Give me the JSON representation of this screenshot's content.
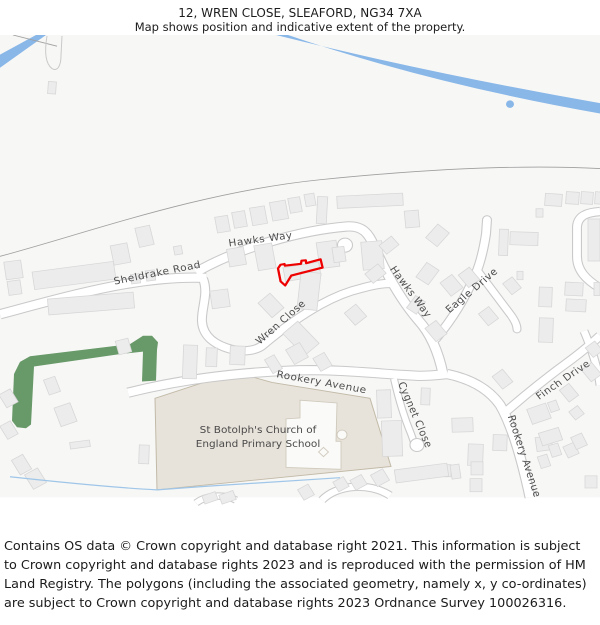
{
  "header": {
    "title": "12, WREN CLOSE, SLEAFORD, NG34 7XA",
    "subtitle": "Map shows position and indicative extent of the property."
  },
  "map": {
    "road_labels": {
      "hawks_way_top": "Hawks Way",
      "sheldrake_road": "Sheldrake Road",
      "wren_close": "Wren Close",
      "hawks_way_east": "Hawks Way",
      "eagle_drive": "Eagle Drive",
      "rookery_avenue_west": "Rookery Avenue",
      "cygnet_close": "Cygnet Close",
      "finch_drive": "Finch Drive",
      "rookery_avenue_south": "Rookery Avenue"
    },
    "places": {
      "school_line1": "St Botolph's Church of",
      "school_line2": "England Primary School"
    },
    "colors": {
      "property_outline": "#ee0000",
      "water": "#88b7e8",
      "greenspace": "#689968",
      "school_fill": "#e8e3da",
      "building_fill": "#ececec",
      "building_stroke": "#d7d7d7",
      "road_fill": "#ffffff",
      "road_casing": "#c9c9c9",
      "background": "#f7f7f6",
      "label_text": "#4d4d4d"
    }
  },
  "footer": {
    "attribution": "Contains OS data © Crown copyright and database right 2021. This information is subject to Crown copyright and database rights 2023 and is reproduced with the permission of HM Land Registry. The polygons (including the associated geometry, namely x, y co-ordinates) are subject to Crown copyright and database rights 2023 Ordnance Survey 100026316."
  }
}
